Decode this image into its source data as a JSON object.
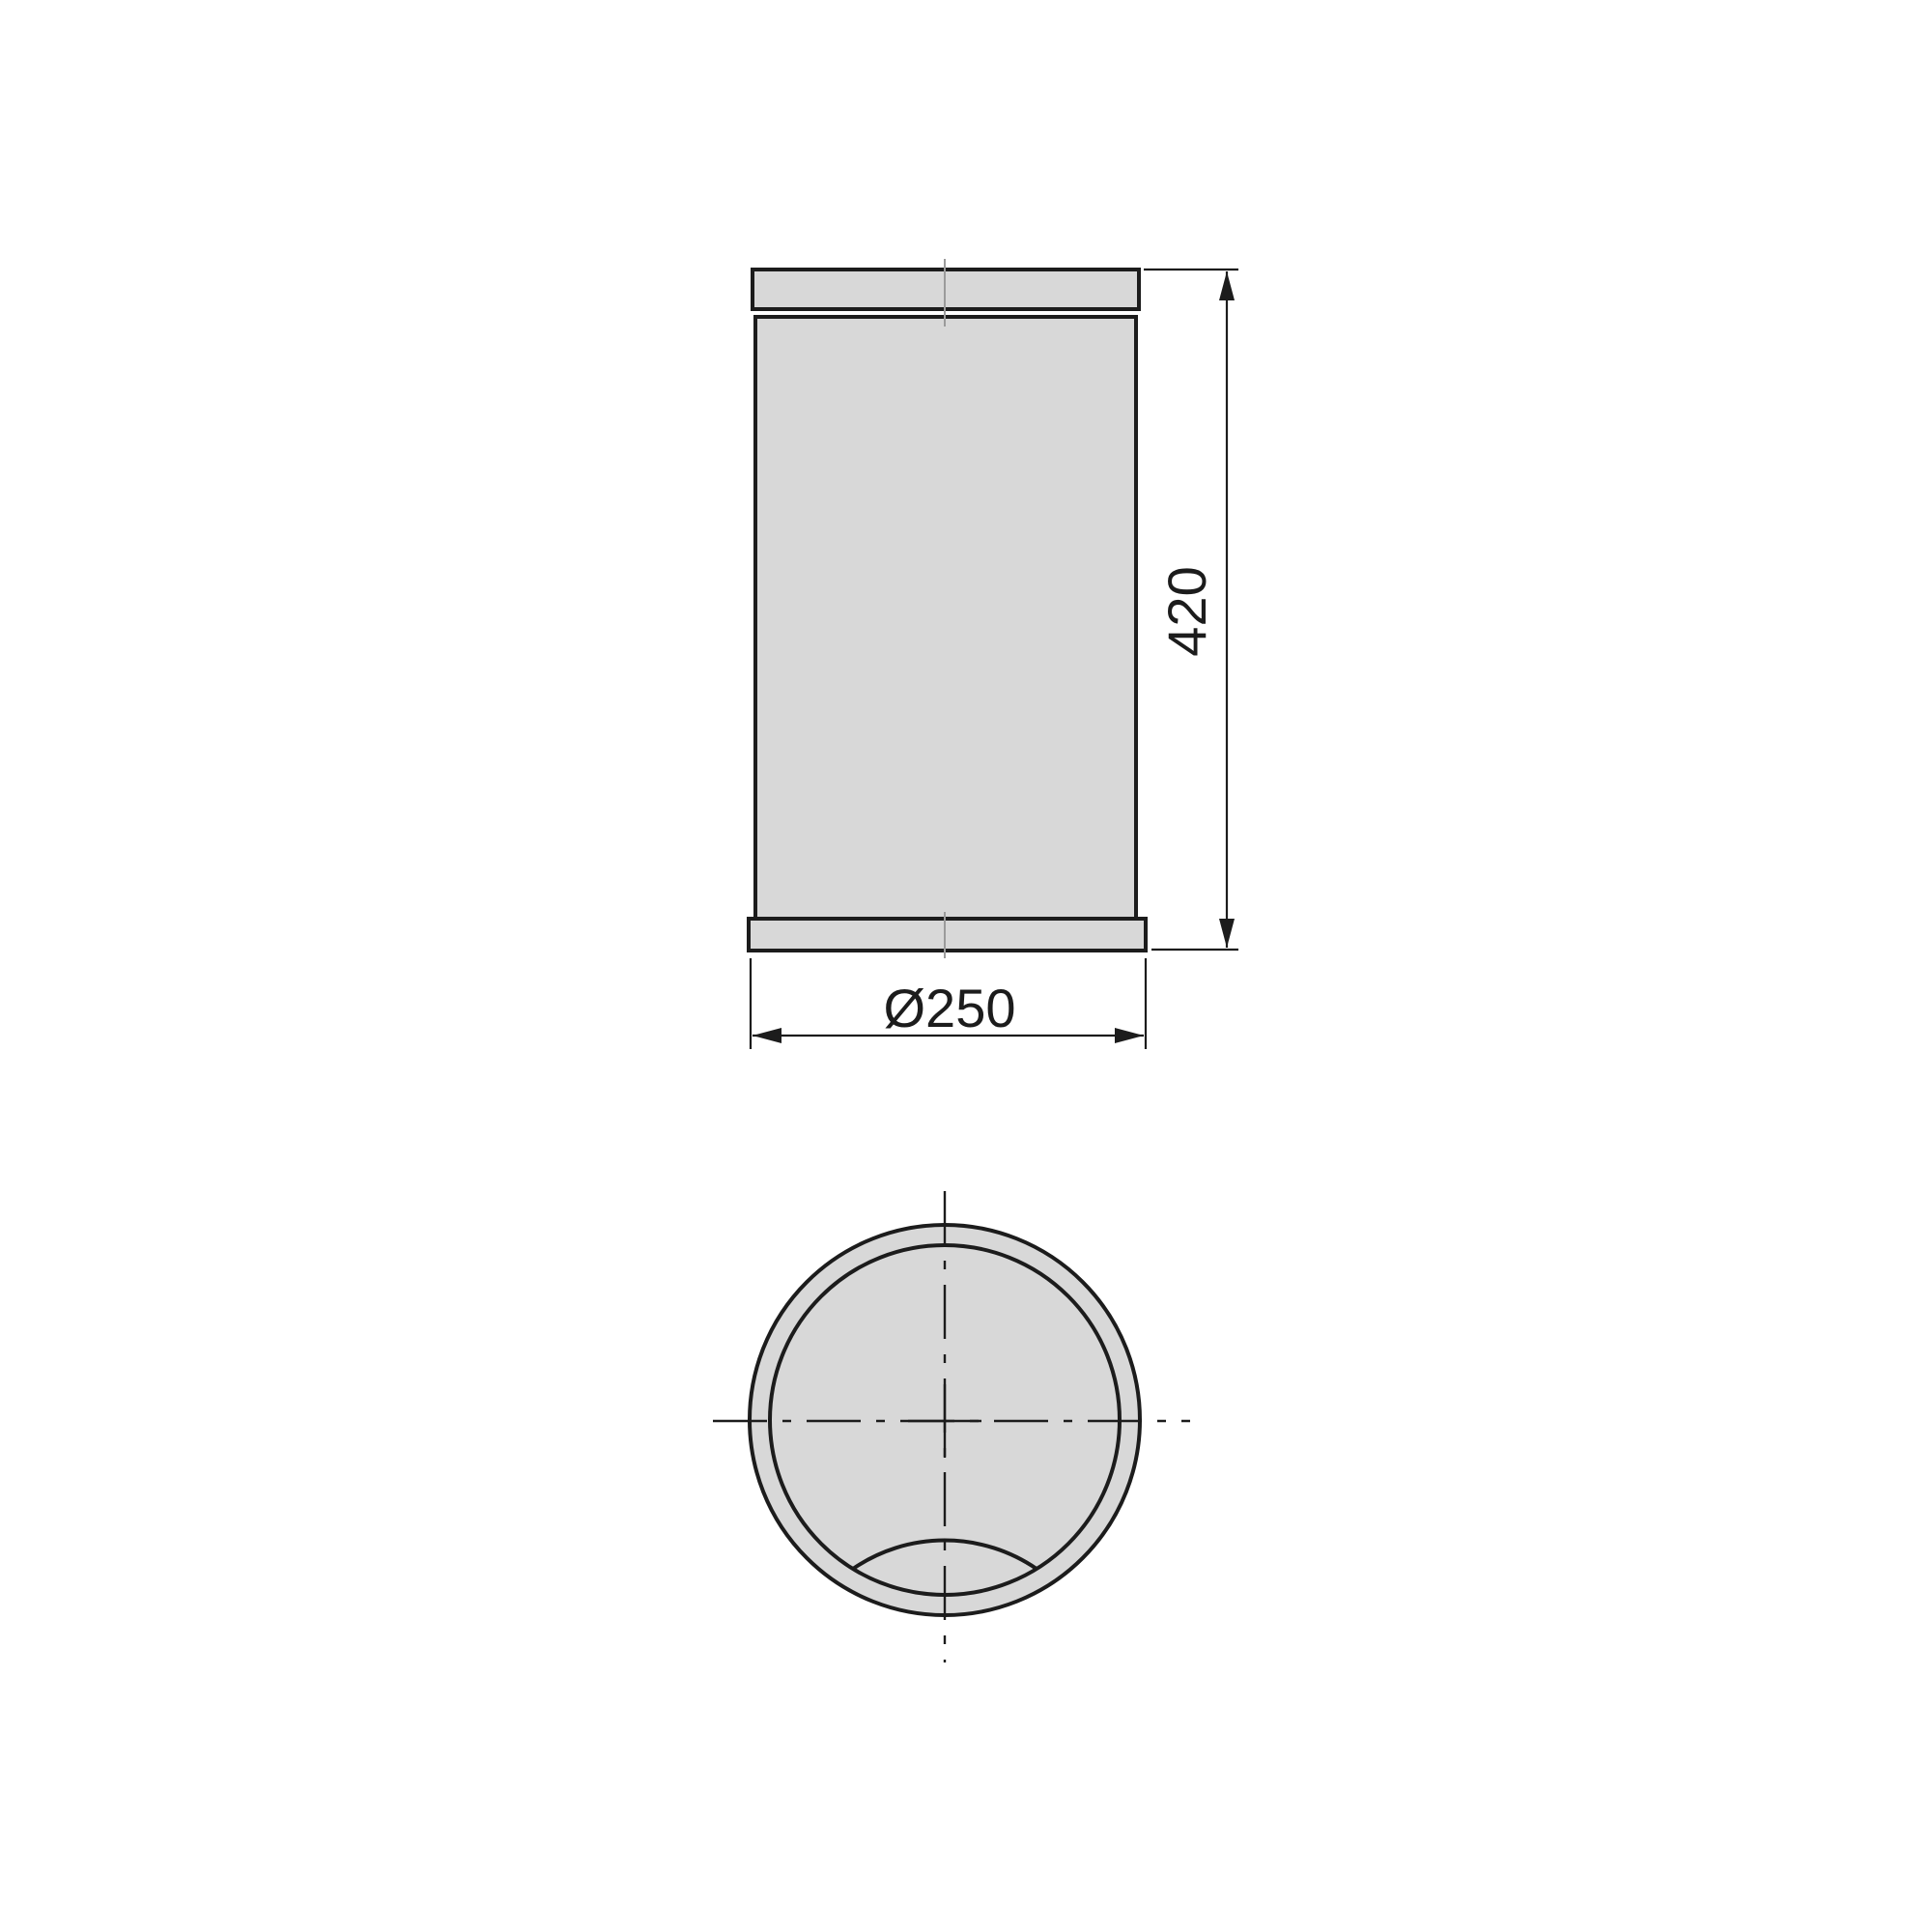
{
  "drawing": {
    "dimensions": {
      "height": {
        "label": "420"
      },
      "diameter": {
        "label": "Ø250"
      }
    },
    "colors": {
      "line": "#1c1c1c",
      "fill": "#d8d8d8",
      "faint_centerline": "#9b9b9b",
      "background": "#ffffff"
    }
  }
}
